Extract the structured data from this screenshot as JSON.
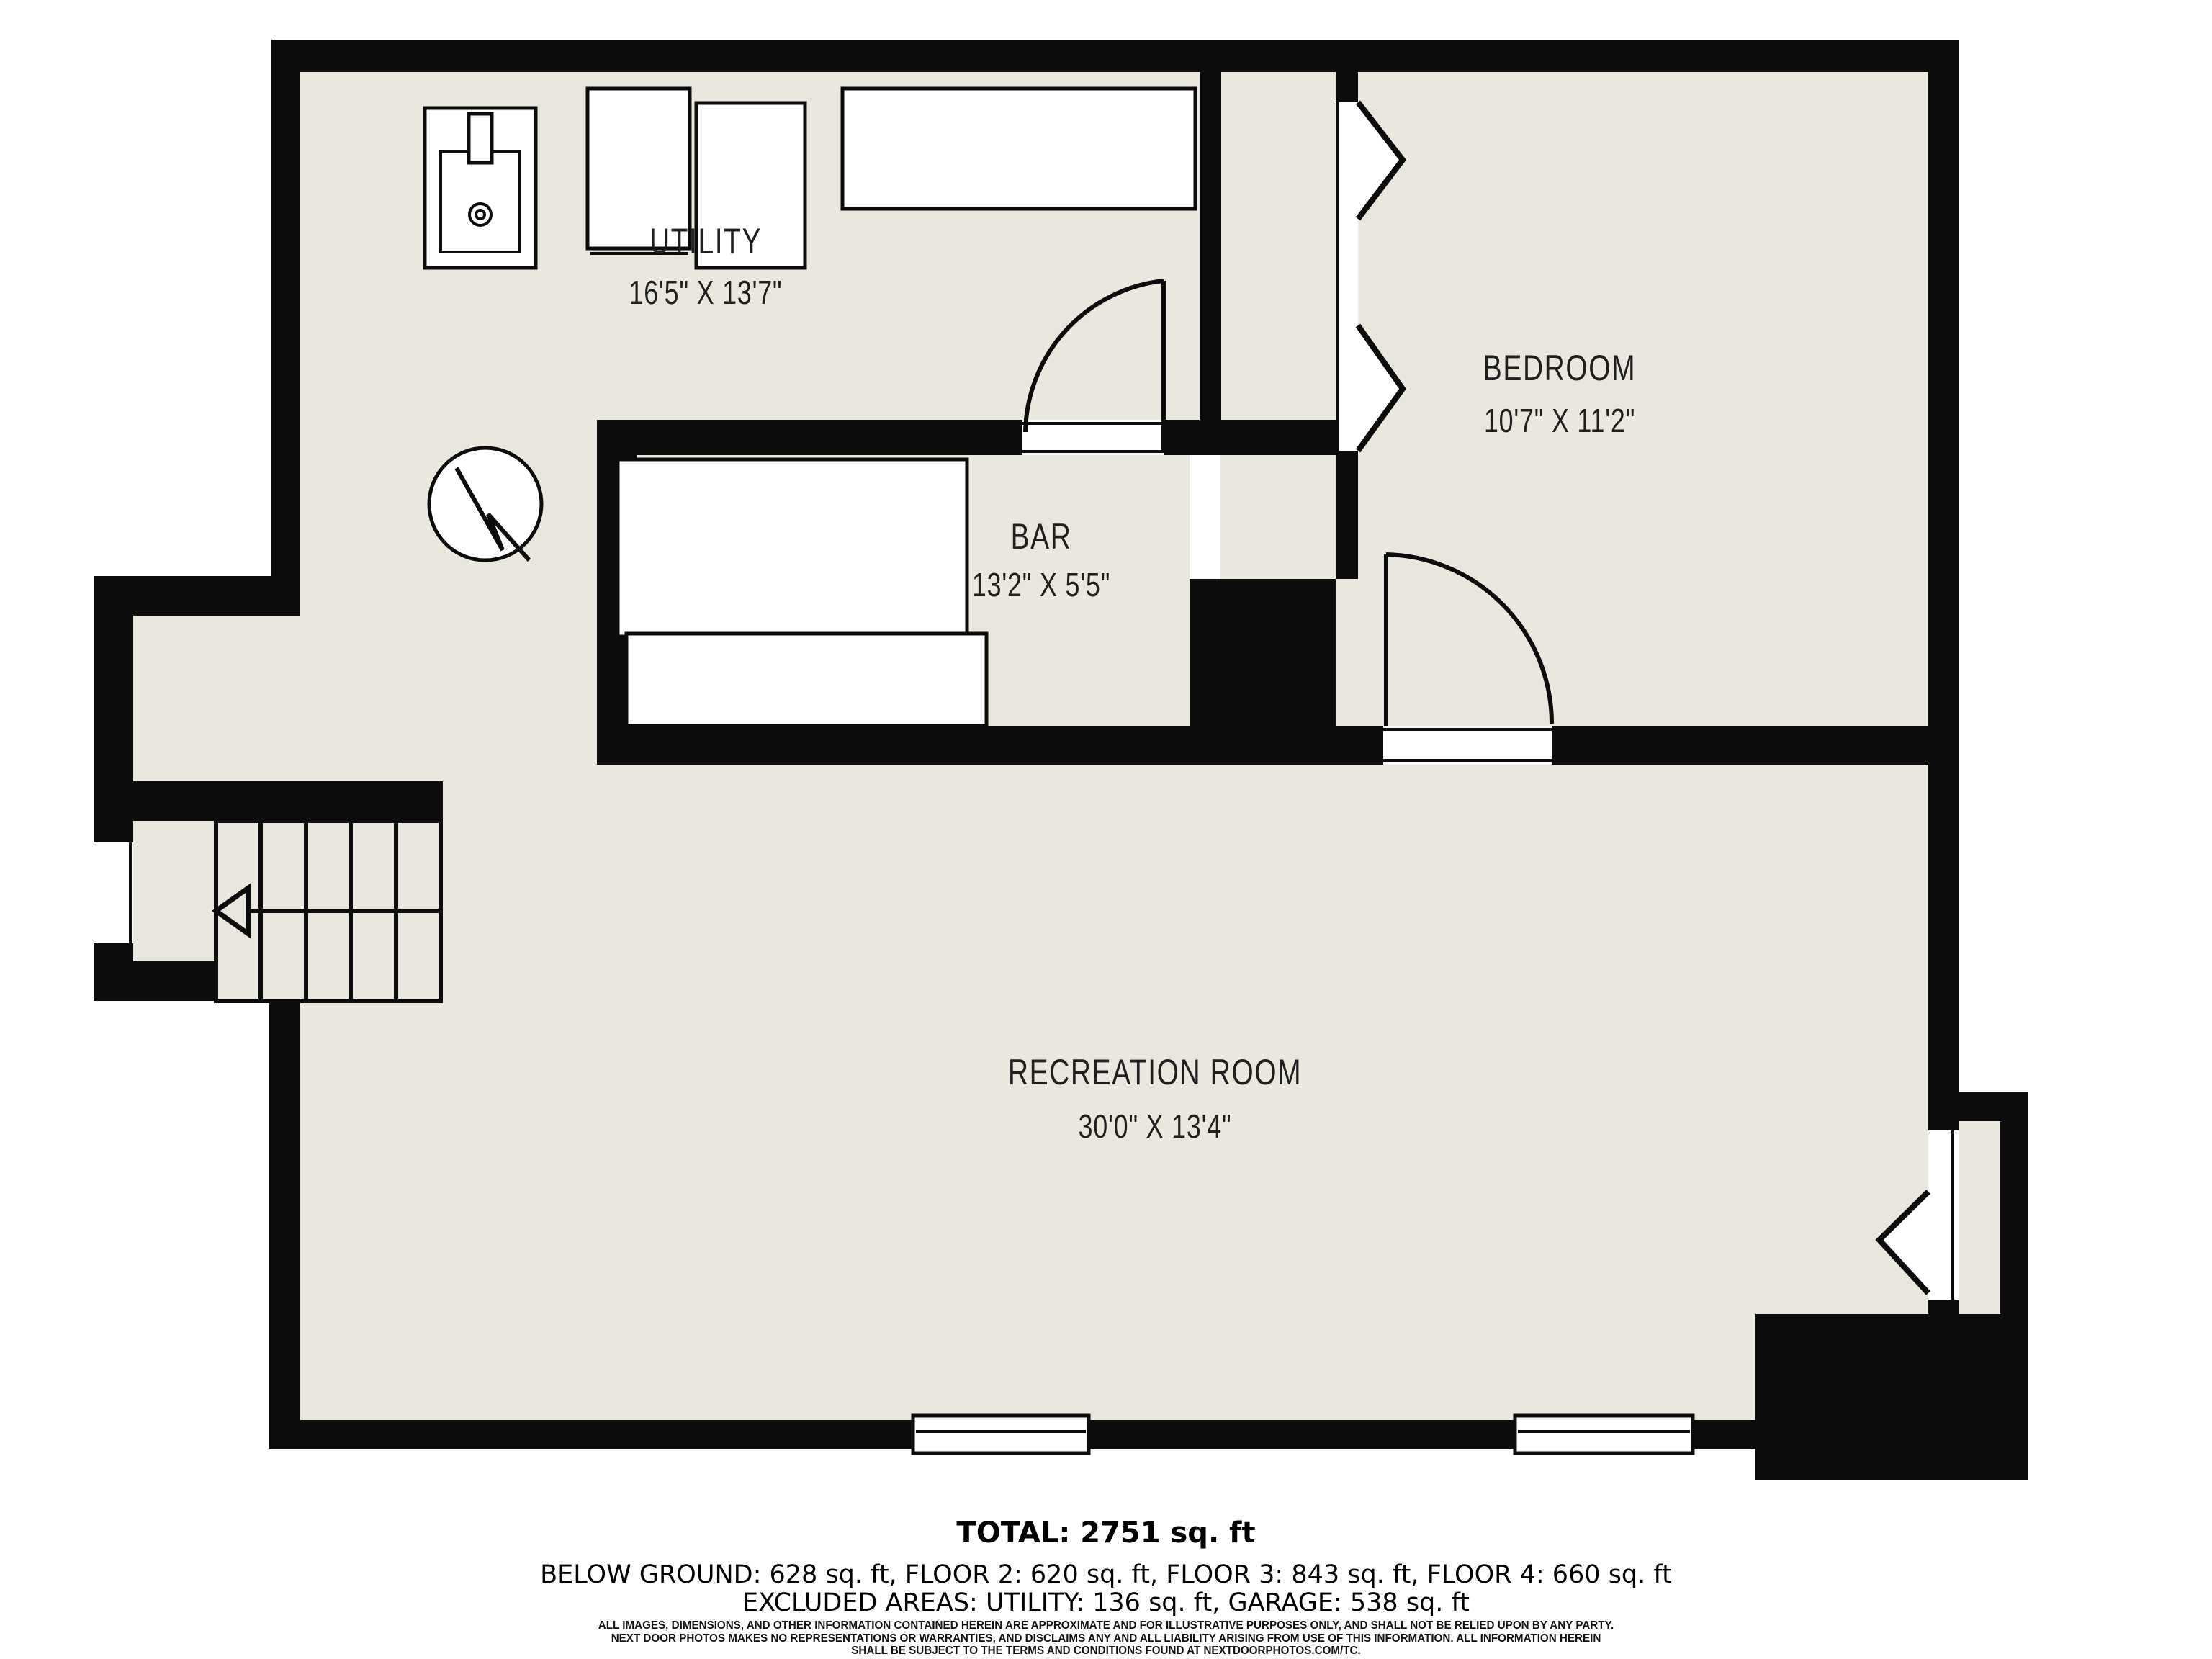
{
  "colors": {
    "wall": "#0c0c0c",
    "floor": "#e9e7de",
    "fixture": "#ffffff",
    "ink": "#1f1f1f",
    "bg": "#ffffff"
  },
  "rooms": {
    "utility": {
      "label": "UTILITY",
      "dims": "16'5\" X 13'7\""
    },
    "bar": {
      "label": "BAR",
      "dims": "13'2\" X 5'5\""
    },
    "bedroom": {
      "label": "BEDROOM",
      "dims": "10'7\" X 11'2\""
    },
    "recreation": {
      "label": "RECREATION ROOM",
      "dims": "30'0\" X 13'4\""
    }
  },
  "summary": {
    "total": "TOTAL: 2751 sq. ft",
    "floors": "BELOW GROUND: 628 sq. ft, FLOOR 2: 620 sq. ft, FLOOR 3: 843 sq. ft, FLOOR 4: 660 sq. ft",
    "excluded": "EXCLUDED AREAS: UTILITY: 136 sq. ft, GARAGE: 538 sq. ft"
  },
  "disclaimer": {
    "line1": "ALL IMAGES, DIMENSIONS, AND OTHER INFORMATION CONTAINED HEREIN ARE APPROXIMATE AND FOR ILLUSTRATIVE PURPOSES ONLY, AND SHALL NOT BE RELIED UPON BY ANY PARTY.",
    "line2": "NEXT DOOR PHOTOS MAKES NO REPRESENTATIONS OR WARRANTIES, AND DISCLAIMS ANY AND ALL LIABILITY ARISING FROM USE OF THIS INFORMATION. ALL INFORMATION HEREIN",
    "line3": "SHALL BE SUBJECT TO THE TERMS AND CONDITIONS FOUND AT NEXTDOORPHOTOS.COM/TC."
  }
}
